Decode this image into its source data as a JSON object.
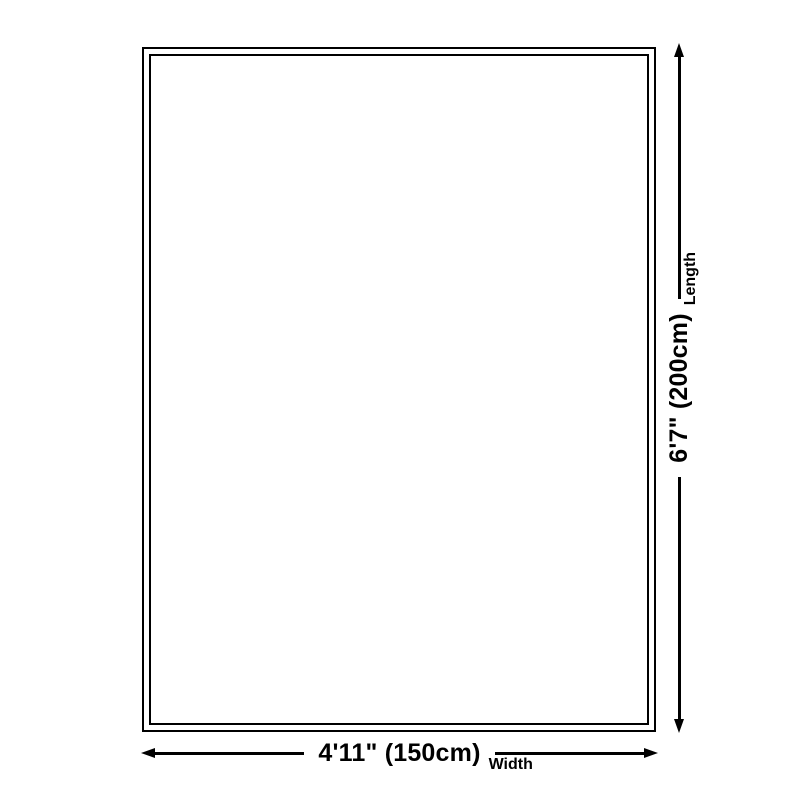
{
  "diagram": {
    "background_color": "#ffffff",
    "line_color": "#000000",
    "product": {
      "shape": "rectangle",
      "border": "double"
    },
    "dimensions": {
      "length": {
        "value": "6'7\" (200cm)",
        "label": "Length",
        "orientation": "vertical",
        "arrow": "double-headed"
      },
      "width": {
        "value": "4'11\" (150cm)",
        "label": "Width",
        "orientation": "horizontal",
        "arrow": "double-headed"
      }
    }
  }
}
